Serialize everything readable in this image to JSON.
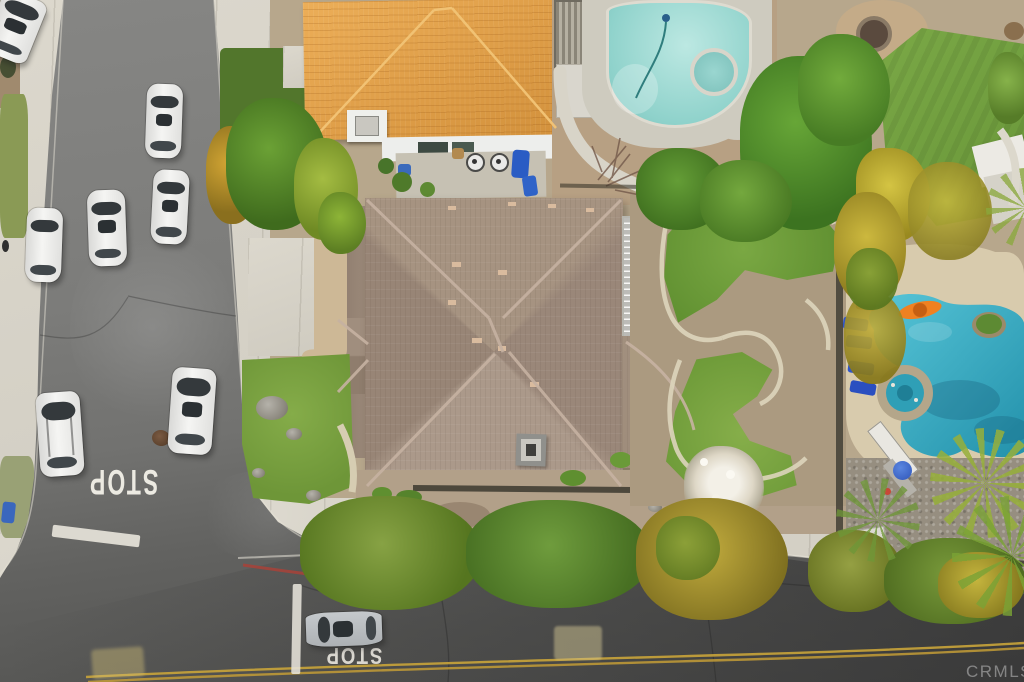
{
  "scene": {
    "type": "aerial-photo",
    "description": "Overhead drone view of a suburban block: tile-roof house, large hip-roof house, two backyard swimming pools, tree-lined streets, and white cars parked along the road",
    "watermark": "CRMLS"
  },
  "markings": {
    "stop_left_road": "STOP",
    "stop_bottom_street": "STOP",
    "stop_bar": "white stop bar",
    "limit_line": "white limit line",
    "center_line": "double yellow line",
    "red_curb": "painted red curb"
  },
  "counts": {
    "parked_cars_left_road": 7,
    "cars_bottom_street": 1,
    "pools": 2,
    "spas": 2
  },
  "palette": {
    "asphalt": "#6f6f6d",
    "sidewalk": "#d7d3c8",
    "tile_roof_orange": "#e2a24e",
    "hip_roof_taupe": "#a19086",
    "pool_top_aqua": "#9ed9d2",
    "pool_right_teal": "#2fa9c0",
    "kayak_orange": "#ef8121",
    "lounger_blue": "#2f55c8",
    "grass_green": "#76a242",
    "dirt_tan": "#b3a189",
    "center_line_yellow": "#c9a43a",
    "red_curb": "#a84238"
  }
}
